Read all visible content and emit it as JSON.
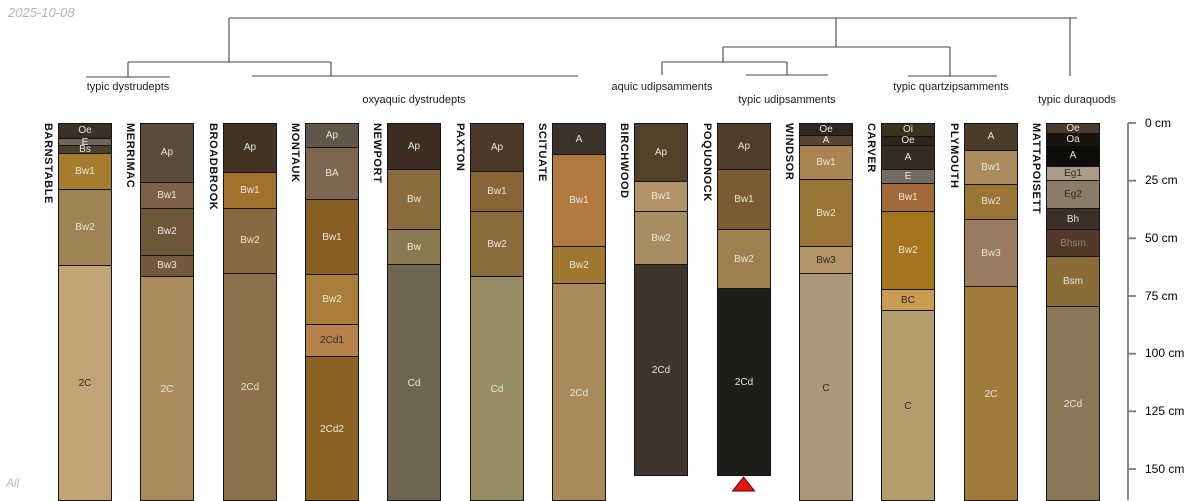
{
  "meta": {
    "date": "2025-10-08",
    "footer": "All"
  },
  "chart_data": {
    "type": "soil-profile-columns-with-dendrogram",
    "depth_axis": {
      "unit": "cm",
      "ticks": [
        0,
        25,
        50,
        75,
        100,
        125,
        150
      ],
      "tick_suffix": " cm"
    },
    "group_labels": [
      {
        "label": "typic dystrudepts",
        "x": 128,
        "y": 81
      },
      {
        "label": "oxyaquic dystrudepts",
        "x": 414,
        "y": 94
      },
      {
        "label": "aquic udipsamments",
        "x": 662,
        "y": 81
      },
      {
        "label": "typic udipsamments",
        "x": 787,
        "y": 94
      },
      {
        "label": "typic quartzipsamments",
        "x": 951,
        "y": 81
      },
      {
        "label": "typic duraquods",
        "x": 1077,
        "y": 94
      }
    ],
    "dendrogram_segments": [
      [
        229,
        18,
        1077,
        18
      ],
      [
        229,
        18,
        229,
        62
      ],
      [
        128,
        62,
        331,
        62
      ],
      [
        128,
        62,
        128,
        77
      ],
      [
        86,
        77,
        170,
        77
      ],
      [
        331,
        62,
        331,
        76
      ],
      [
        252,
        76,
        578,
        76
      ],
      [
        836,
        18,
        836,
        47
      ],
      [
        723,
        47,
        950,
        47
      ],
      [
        723,
        47,
        723,
        62
      ],
      [
        662,
        62,
        787,
        62
      ],
      [
        662,
        62,
        662,
        75
      ],
      [
        787,
        62,
        787,
        75
      ],
      [
        746,
        75,
        828,
        75
      ],
      [
        950,
        47,
        950,
        76
      ],
      [
        908,
        76,
        997,
        76
      ],
      [
        1070,
        18,
        1070,
        76
      ]
    ],
    "profiles": [
      {
        "name": "BARNSTABLE",
        "horizons": [
          {
            "label": "Oe",
            "top_cm": 0,
            "bottom_cm": 6.0,
            "color": "#3b3227",
            "text": "light"
          },
          {
            "label": "E",
            "top_cm": 6.0,
            "bottom_cm": 9.3,
            "color": "#6f675c",
            "text": "light"
          },
          {
            "label": "Bs",
            "top_cm": 9.3,
            "bottom_cm": 12.4,
            "color": "#4e3f2d",
            "text": "light"
          },
          {
            "label": "Bw1",
            "top_cm": 12.4,
            "bottom_cm": 28.0,
            "color": "#a67c2f",
            "text": "light"
          },
          {
            "label": "Bw2",
            "top_cm": 28.0,
            "bottom_cm": 61.0,
            "color": "#9d8455",
            "text": "light"
          },
          {
            "label": "2C",
            "top_cm": 61.0,
            "bottom_cm": 164,
            "color": "#c3a476",
            "text": "dark"
          }
        ]
      },
      {
        "name": "MERRIMAC",
        "horizons": [
          {
            "label": "Ap",
            "top_cm": 0,
            "bottom_cm": 25.0,
            "color": "#5a4b3b",
            "text": "light"
          },
          {
            "label": "Bw1",
            "top_cm": 25.0,
            "bottom_cm": 36.6,
            "color": "#7e6049",
            "text": "light"
          },
          {
            "label": "Bw2",
            "top_cm": 36.6,
            "bottom_cm": 56.6,
            "color": "#6e5639",
            "text": "light"
          },
          {
            "label": "Bw3",
            "top_cm": 56.6,
            "bottom_cm": 66.0,
            "color": "#73593c",
            "text": "light"
          },
          {
            "label": "2C",
            "top_cm": 66.0,
            "bottom_cm": 164,
            "color": "#ab8c60",
            "text": "light"
          }
        ]
      },
      {
        "name": "BROADBROOK",
        "horizons": [
          {
            "label": "Ap",
            "top_cm": 0,
            "bottom_cm": 20.6,
            "color": "#413425",
            "text": "light"
          },
          {
            "label": "Bw1",
            "top_cm": 20.6,
            "bottom_cm": 36.2,
            "color": "#a1722b",
            "text": "light"
          },
          {
            "label": "Bw2",
            "top_cm": 36.2,
            "bottom_cm": 64.4,
            "color": "#89693f",
            "text": "light"
          },
          {
            "label": "2Cd",
            "top_cm": 64.4,
            "bottom_cm": 164,
            "color": "#8a7149",
            "text": "light"
          }
        ]
      },
      {
        "name": "MONTAUK",
        "horizons": [
          {
            "label": "Ap",
            "top_cm": 0,
            "bottom_cm": 9.8,
            "color": "#615649",
            "text": "light"
          },
          {
            "label": "BA",
            "top_cm": 9.8,
            "bottom_cm": 32.7,
            "color": "#7d6750",
            "text": "light"
          },
          {
            "label": "Bw1",
            "top_cm": 32.7,
            "bottom_cm": 65.2,
            "color": "#875f25",
            "text": "light"
          },
          {
            "label": "Bw2",
            "top_cm": 65.2,
            "bottom_cm": 86.8,
            "color": "#a87e38",
            "text": "light"
          },
          {
            "label": "2Cd1",
            "top_cm": 86.8,
            "bottom_cm": 100.8,
            "color": "#b5824b",
            "text": "dark"
          },
          {
            "label": "2Cd2",
            "top_cm": 100.8,
            "bottom_cm": 164,
            "color": "#8a6222",
            "text": "light"
          }
        ]
      },
      {
        "name": "NEWPORT",
        "horizons": [
          {
            "label": "Ap",
            "top_cm": 0,
            "bottom_cm": 19.7,
            "color": "#3b2e20",
            "text": "light"
          },
          {
            "label": "Bw",
            "top_cm": 19.7,
            "bottom_cm": 45.7,
            "color": "#8a6c3e",
            "text": "light"
          },
          {
            "label": "Bw",
            "top_cm": 45.7,
            "bottom_cm": 60.9,
            "color": "#8a7a50",
            "text": "light"
          },
          {
            "label": "Cd",
            "top_cm": 60.9,
            "bottom_cm": 164,
            "color": "#6f6551",
            "text": "light"
          }
        ]
      },
      {
        "name": "PAXTON",
        "horizons": [
          {
            "label": "Ap",
            "top_cm": 0,
            "bottom_cm": 20.2,
            "color": "#4a3929",
            "text": "light"
          },
          {
            "label": "Bw1",
            "top_cm": 20.2,
            "bottom_cm": 37.9,
            "color": "#8a6336",
            "text": "light"
          },
          {
            "label": "Bw2",
            "top_cm": 37.9,
            "bottom_cm": 66.1,
            "color": "#8a6d3b",
            "text": "light"
          },
          {
            "label": "Cd",
            "top_cm": 66.1,
            "bottom_cm": 164,
            "color": "#968d66",
            "text": "light"
          }
        ]
      },
      {
        "name": "SCITUATE",
        "horizons": [
          {
            "label": "A",
            "top_cm": 0,
            "bottom_cm": 13.2,
            "color": "#3b322a",
            "text": "light"
          },
          {
            "label": "Bw1",
            "top_cm": 13.2,
            "bottom_cm": 53.1,
            "color": "#b07a41",
            "text": "light"
          },
          {
            "label": "Bw2",
            "top_cm": 53.1,
            "bottom_cm": 69.1,
            "color": "#a0772e",
            "text": "light"
          },
          {
            "label": "2Cd",
            "top_cm": 69.1,
            "bottom_cm": 164,
            "color": "#a88a5d",
            "text": "light"
          }
        ]
      },
      {
        "name": "BIRCHWOOD",
        "horizons": [
          {
            "label": "Ap",
            "top_cm": 0,
            "bottom_cm": 24.9,
            "color": "#53412b",
            "text": "light"
          },
          {
            "label": "Bw1",
            "top_cm": 24.9,
            "bottom_cm": 37.9,
            "color": "#b29468",
            "text": "light"
          },
          {
            "label": "Bw2",
            "top_cm": 37.9,
            "bottom_cm": 60.9,
            "color": "#a78d62",
            "text": "light"
          },
          {
            "label": "2Cd",
            "top_cm": 60.9,
            "bottom_cm": 152,
            "color": "#3f352a",
            "text": "light"
          }
        ]
      },
      {
        "name": "POQUONOCK",
        "horizons": [
          {
            "label": "Ap",
            "top_cm": 0,
            "bottom_cm": 19.7,
            "color": "#4d3d29",
            "text": "light"
          },
          {
            "label": "Bw1",
            "top_cm": 19.7,
            "bottom_cm": 45.7,
            "color": "#7d5c34",
            "text": "light"
          },
          {
            "label": "Bw2",
            "top_cm": 45.7,
            "bottom_cm": 71.3,
            "color": "#a08050",
            "text": "light"
          },
          {
            "label": "2Cd",
            "top_cm": 71.3,
            "bottom_cm": 152,
            "color": "#1f1d19",
            "text": "light"
          }
        ]
      },
      {
        "name": "WINDSOR",
        "horizons": [
          {
            "label": "Oe",
            "top_cm": 0,
            "bottom_cm": 4.6,
            "color": "#2f271d",
            "text": "light"
          },
          {
            "label": "A",
            "top_cm": 4.6,
            "bottom_cm": 8.9,
            "color": "#564534",
            "text": "light"
          },
          {
            "label": "Bw1",
            "top_cm": 8.9,
            "bottom_cm": 24.0,
            "color": "#ab8454",
            "text": "light"
          },
          {
            "label": "Bw2",
            "top_cm": 24.0,
            "bottom_cm": 53.1,
            "color": "#9a7435",
            "text": "light"
          },
          {
            "label": "Bw3",
            "top_cm": 53.1,
            "bottom_cm": 64.8,
            "color": "#b49468",
            "text": "dark"
          },
          {
            "label": "C",
            "top_cm": 64.8,
            "bottom_cm": 164,
            "color": "#ac9878",
            "text": "dark"
          }
        ]
      },
      {
        "name": "CARVER",
        "horizons": [
          {
            "label": "Oi",
            "top_cm": 0,
            "bottom_cm": 5.0,
            "color": "#3a311f",
            "text": "light"
          },
          {
            "label": "Oe",
            "top_cm": 5.0,
            "bottom_cm": 9.3,
            "color": "#2d251b",
            "text": "light"
          },
          {
            "label": "A",
            "top_cm": 9.3,
            "bottom_cm": 19.7,
            "color": "#352b21",
            "text": "light"
          },
          {
            "label": "E",
            "top_cm": 19.7,
            "bottom_cm": 25.8,
            "color": "#736b5f",
            "text": "light"
          },
          {
            "label": "Bw1",
            "top_cm": 25.8,
            "bottom_cm": 37.9,
            "color": "#a06b39",
            "text": "light"
          },
          {
            "label": "Bw2",
            "top_cm": 37.9,
            "bottom_cm": 71.7,
            "color": "#a4751d",
            "text": "light"
          },
          {
            "label": "BC",
            "top_cm": 71.7,
            "bottom_cm": 80.8,
            "color": "#c99b53",
            "text": "dark"
          },
          {
            "label": "C",
            "top_cm": 80.8,
            "bottom_cm": 164,
            "color": "#b39d6f",
            "text": "dark"
          }
        ]
      },
      {
        "name": "PLYMOUTH",
        "horizons": [
          {
            "label": "A",
            "top_cm": 0,
            "bottom_cm": 11.1,
            "color": "#4b3c29",
            "text": "light"
          },
          {
            "label": "Bw1",
            "top_cm": 11.1,
            "bottom_cm": 25.8,
            "color": "#ab8b5d",
            "text": "light"
          },
          {
            "label": "Bw2",
            "top_cm": 25.8,
            "bottom_cm": 41.4,
            "color": "#9a7435",
            "text": "light"
          },
          {
            "label": "Bw3",
            "top_cm": 41.4,
            "bottom_cm": 70.4,
            "color": "#9b7b5d",
            "text": "light"
          },
          {
            "label": "2C",
            "top_cm": 70.4,
            "bottom_cm": 164,
            "color": "#a17b39",
            "text": "light"
          }
        ]
      },
      {
        "name": "MATTAPOISETT",
        "horizons": [
          {
            "label": "Oe",
            "top_cm": 0,
            "bottom_cm": 3.7,
            "color": "#4b3b2d",
            "text": "light"
          },
          {
            "label": "Oa",
            "top_cm": 3.7,
            "bottom_cm": 8.9,
            "color": "#171410",
            "text": "light"
          },
          {
            "label": "A",
            "top_cm": 8.9,
            "bottom_cm": 18.4,
            "color": "#0e0c09",
            "text": "light"
          },
          {
            "label": "Eg1",
            "top_cm": 18.4,
            "bottom_cm": 24.1,
            "color": "#a99b87",
            "text": "dark"
          },
          {
            "label": "Eg2",
            "top_cm": 24.1,
            "bottom_cm": 36.6,
            "color": "#8b7b69",
            "text": "dark"
          },
          {
            "label": "Bh",
            "top_cm": 36.6,
            "bottom_cm": 45.7,
            "color": "#3b2f27",
            "text": "light"
          },
          {
            "label": "Bhsm",
            "top_cm": 45.7,
            "bottom_cm": 57.4,
            "color": "#533929",
            "text": "muted"
          },
          {
            "label": "Bsm",
            "top_cm": 57.4,
            "bottom_cm": 79.1,
            "color": "#8b6b36",
            "text": "light"
          },
          {
            "label": "2Cd",
            "top_cm": 79.1,
            "bottom_cm": 164,
            "color": "#8b7657",
            "text": "light"
          }
        ]
      }
    ],
    "marker": {
      "profile": "POQUONOCK",
      "profile_index": 8,
      "shape": "triangle-up",
      "color": "#ee1111"
    },
    "style": {
      "line_color": "#464646",
      "axis_color": "#7c7c7c",
      "border_color": "#141414"
    }
  }
}
